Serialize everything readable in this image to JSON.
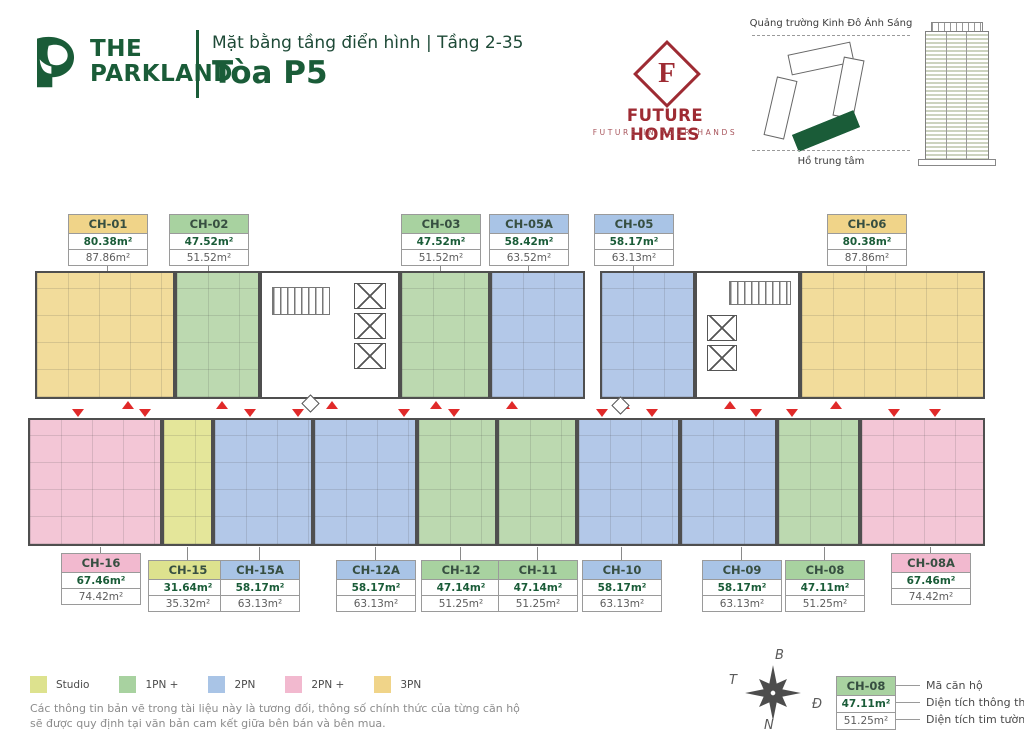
{
  "header": {
    "brand_top": "THE",
    "brand_bottom": "PARKLAND",
    "subtitle": "Mặt bằng tầng điển hình | Tầng 2-35",
    "title": "Tòa P5"
  },
  "future_homes": {
    "letter": "F",
    "name": "FUTURE HOMES",
    "tagline": "FUTURE IN YOUR HANDS"
  },
  "site_map": {
    "top_label": "Quảng trường Kinh Đô Ánh Sáng",
    "bottom_label": "Hồ trung tâm"
  },
  "units_top": [
    {
      "code": "CH-01",
      "area_net": "80.38m²",
      "area_gross": "87.86m²",
      "type": "3PN"
    },
    {
      "code": "CH-02",
      "area_net": "47.52m²",
      "area_gross": "51.52m²",
      "type": "1PN+"
    },
    {
      "code": "CH-03",
      "area_net": "47.52m²",
      "area_gross": "51.52m²",
      "type": "1PN+"
    },
    {
      "code": "CH-05A",
      "area_net": "58.42m²",
      "area_gross": "63.52m²",
      "type": "2PN"
    },
    {
      "code": "CH-05",
      "area_net": "58.17m²",
      "area_gross": "63.13m²",
      "type": "2PN"
    },
    {
      "code": "CH-06",
      "area_net": "80.38m²",
      "area_gross": "87.86m²",
      "type": "3PN"
    }
  ],
  "units_bottom": [
    {
      "code": "CH-16",
      "area_net": "67.46m²",
      "area_gross": "74.42m²",
      "type": "2PN+"
    },
    {
      "code": "CH-15",
      "area_net": "31.64m²",
      "area_gross": "35.32m²",
      "type": "Studio"
    },
    {
      "code": "CH-15A",
      "area_net": "58.17m²",
      "area_gross": "63.13m²",
      "type": "2PN"
    },
    {
      "code": "CH-12A",
      "area_net": "58.17m²",
      "area_gross": "63.13m²",
      "type": "2PN"
    },
    {
      "code": "CH-12",
      "area_net": "47.14m²",
      "area_gross": "51.25m²",
      "type": "1PN+"
    },
    {
      "code": "CH-11",
      "area_net": "47.14m²",
      "area_gross": "51.25m²",
      "type": "1PN+"
    },
    {
      "code": "CH-10",
      "area_net": "58.17m²",
      "area_gross": "63.13m²",
      "type": "2PN"
    },
    {
      "code": "CH-09",
      "area_net": "58.17m²",
      "area_gross": "63.13m²",
      "type": "2PN"
    },
    {
      "code": "CH-08",
      "area_net": "47.11m²",
      "area_gross": "51.25m²",
      "type": "1PN+"
    },
    {
      "code": "CH-08A",
      "area_net": "67.46m²",
      "area_gross": "74.42m²",
      "type": "2PN+"
    }
  ],
  "legend": {
    "items": [
      {
        "label": "Studio",
        "color": "#dde28e"
      },
      {
        "label": "1PN +",
        "color": "#a8d2a0"
      },
      {
        "label": "2PN",
        "color": "#a9c4e6"
      },
      {
        "label": "2PN +",
        "color": "#f2b9cf"
      },
      {
        "label": "3PN",
        "color": "#f0d489"
      }
    ],
    "disclaimer_line1": "Các thông tin bản vẽ trong tài liệu này là tương đối, thông số chính thức của từng căn hộ",
    "disclaimer_line2": "sẽ được quy định tại văn bản cam kết giữa bên bán và bên mua."
  },
  "compass": {
    "north": "B",
    "east": "Đ",
    "south": "N",
    "west": "T"
  },
  "key_box": {
    "code": "CH-08",
    "area_net": "47.11m²",
    "area_gross": "51.25m²",
    "label_code": "Mã căn hộ",
    "label_net": "Diện tích thông thủy",
    "label_gross": "Diện tích tim tường"
  },
  "colors": {
    "brand_green": "#1a5c38",
    "future_homes_red": "#9e2b33",
    "studio": "#dde28e",
    "one_pn_plus": "#a8d2a0",
    "two_pn": "#a9c4e6",
    "two_pn_plus": "#f2b9cf",
    "three_pn": "#f0d489",
    "arrow_red": "#e02a2a"
  }
}
